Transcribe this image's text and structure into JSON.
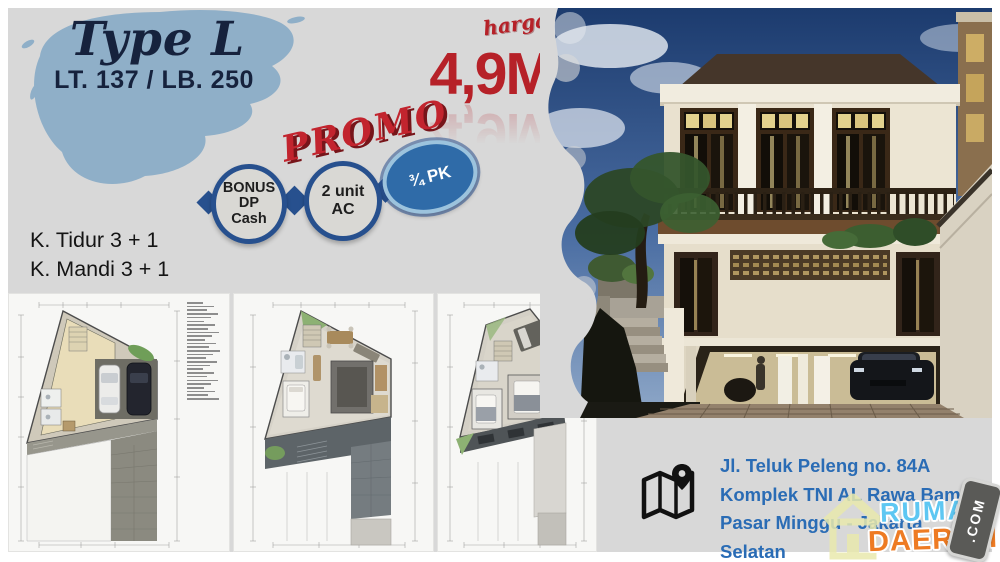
{
  "header": {
    "type_label": "Type L",
    "size_label": "LT. 137 / LB. 250"
  },
  "price": {
    "label": "harga",
    "value": "4,9M"
  },
  "promo": {
    "title": "PROMO",
    "bubbles": [
      {
        "lines": [
          "BONUS",
          "DP",
          "Cash"
        ]
      },
      {
        "lines": [
          "2 unit",
          "AC"
        ]
      },
      {
        "lines": [
          "¾ PK"
        ]
      }
    ]
  },
  "specs": {
    "items": [
      "K. Tidur 3 + 1",
      "K. Mandi 3 + 1"
    ]
  },
  "floorplans": {
    "count": 3,
    "panels": [
      "ground-floor-site-plan",
      "second-floor-plan",
      "third-floor-plan"
    ],
    "legend_lines": 27
  },
  "address": {
    "lines": [
      "Jl. Teluk Peleng no. 84A",
      "Komplek TNI AL Rawa Bambu",
      "Pasar Minggu - Jakarta Selatan"
    ]
  },
  "watermark": {
    "rumah": "RUMAH",
    "daerah": "DAERAH",
    "com": ".COM"
  },
  "palette": {
    "background": "#d8d8d8",
    "brush_blue": "#8fafc8",
    "navy": "#16223d",
    "price_red": "#b62128",
    "bubble_border": "#27508e",
    "pk_fill": "#2f6ba8",
    "address_blue": "#2a6cb5",
    "rumah_blue": "#5ec7f2",
    "daerah_orange": "#ee7b23"
  }
}
